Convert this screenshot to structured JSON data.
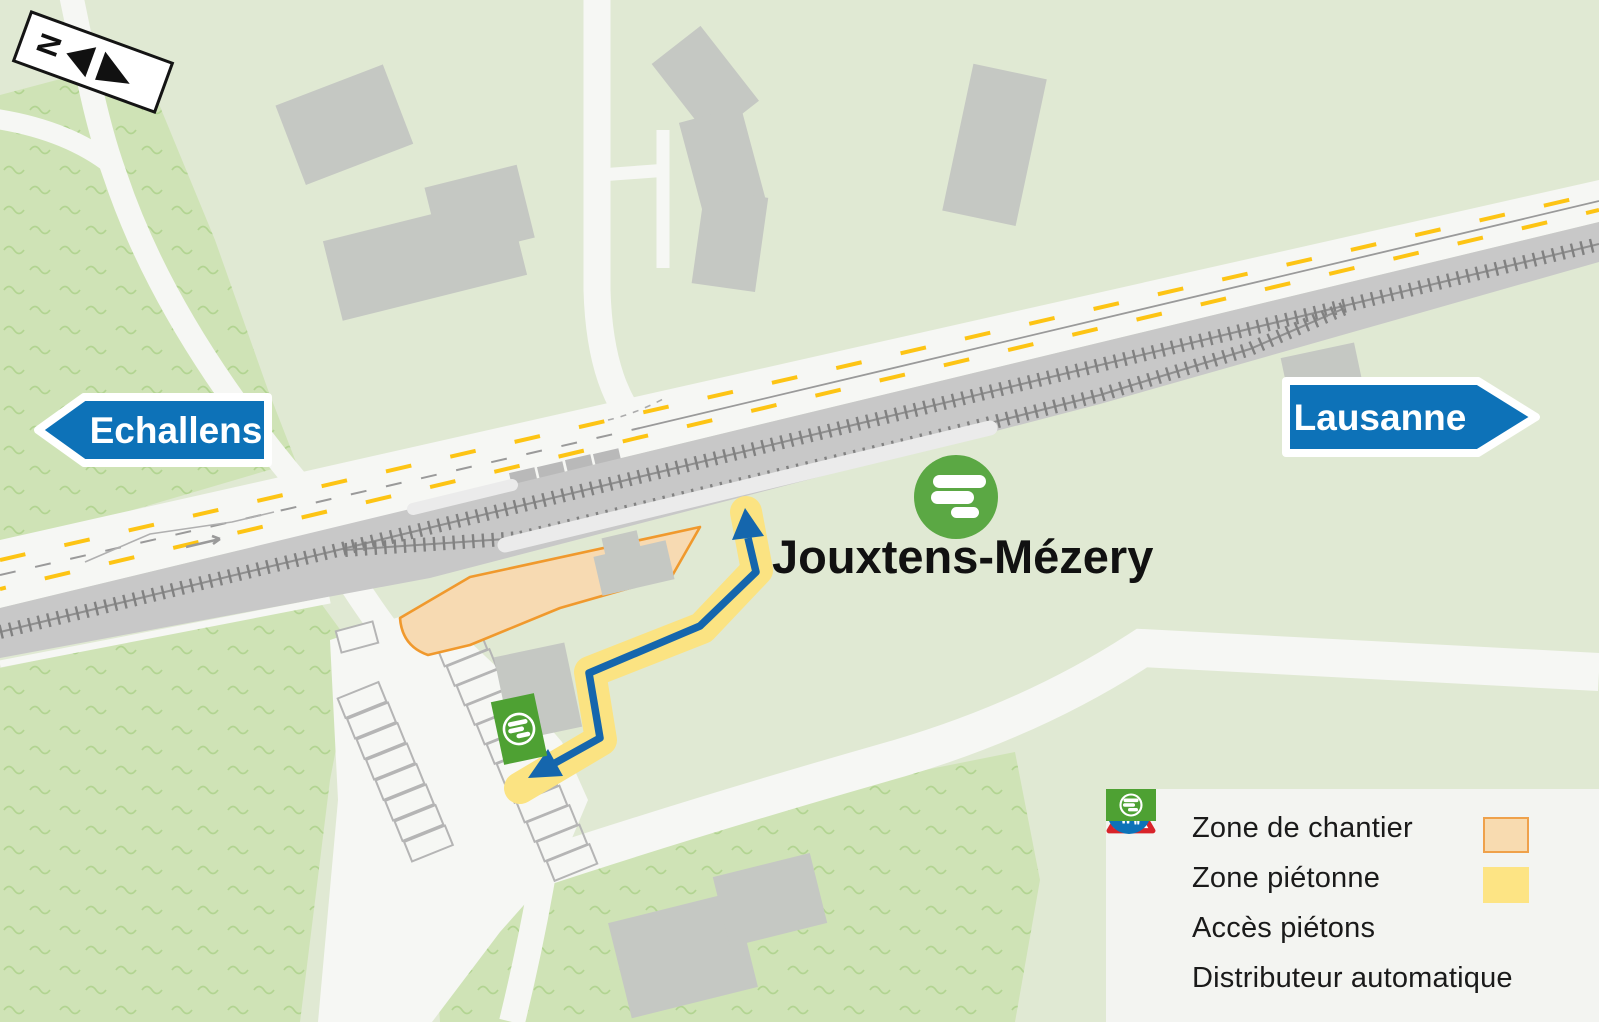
{
  "map": {
    "station_label": "Jouxtens-Mézery",
    "sign_left": "Echallens",
    "sign_right": "Lausanne",
    "compass_letter": "N"
  },
  "legend": {
    "items": [
      {
        "label": "Zone de chantier",
        "icon": "construction-sign-icon",
        "swatch": "#F8DBB0",
        "swatch_border": "#EFA14B"
      },
      {
        "label": "Zone piétonne",
        "icon": "pedestrian-sign-icon",
        "swatch": "#FDE484",
        "swatch_border": "#FDE484"
      },
      {
        "label": "Accès piétons",
        "icon": "pedestrian-access-arrow-icon",
        "swatch": null,
        "swatch_border": null
      },
      {
        "label": "Distributeur automatique",
        "icon": "ticket-machine-icon",
        "swatch": null,
        "swatch_border": null
      }
    ]
  },
  "colors": {
    "background_green": "#e0e9d3",
    "textured_green": "#cfe3b6",
    "road_white": "#f6f7f4",
    "railway_gray": "#c8c8c8",
    "tie_gray": "#818181",
    "building_gray": "#c5c8c3",
    "lane_yellow": "#FDC414",
    "sign_blue": "#0D72B8",
    "arrow_blue": "#1566AD",
    "construction_fill": "#F7DAB2",
    "construction_border": "#F0992D",
    "pedestrian_yellow": "#FBE382",
    "leb_green": "#5BA844",
    "machine_green": "#4EA133"
  }
}
